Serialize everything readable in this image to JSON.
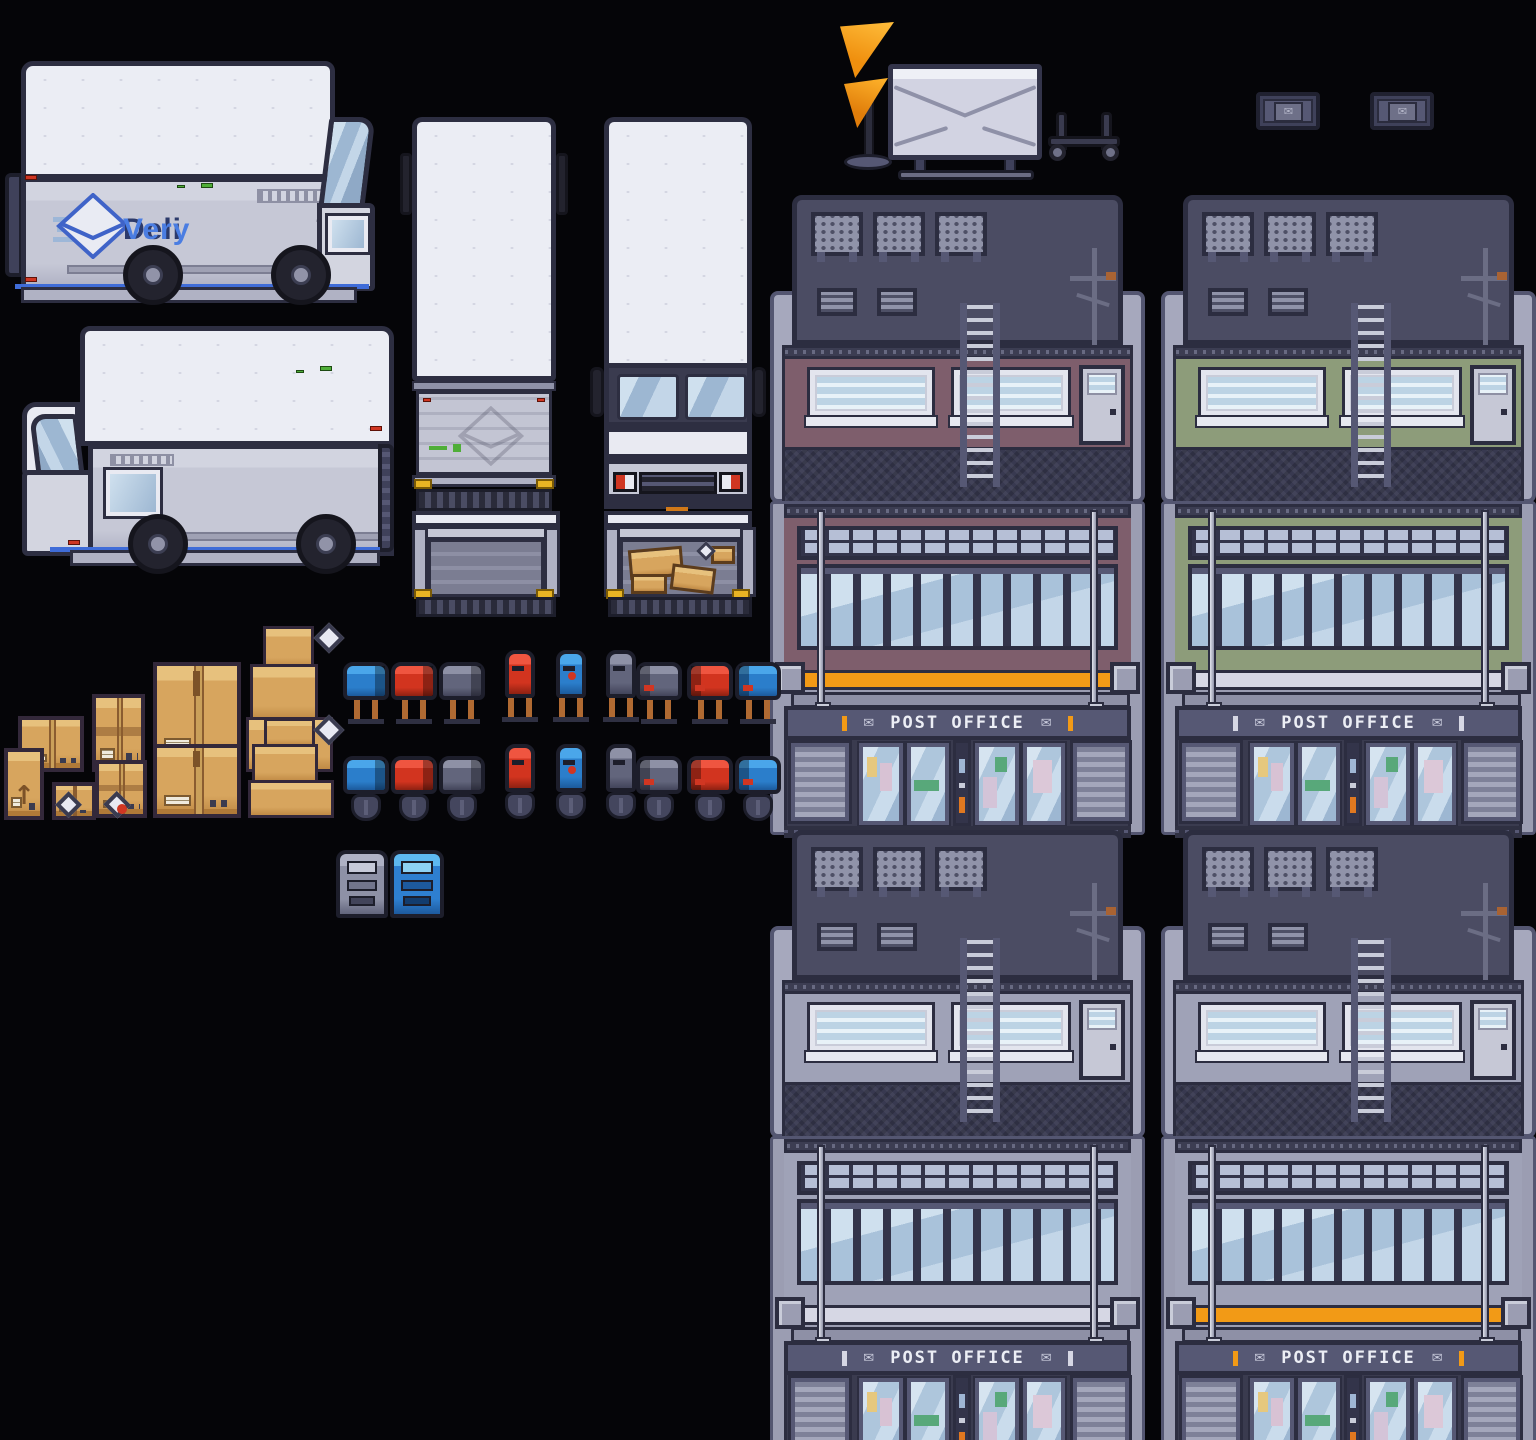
{
  "canvas": {
    "width": 1536,
    "height": 1440,
    "background": "#050508"
  },
  "truck_branding": {
    "logo_prefix": "Deli",
    "logo_suffix": "Very",
    "logo_prefix_color": "#2c3a6b",
    "logo_suffix_color": "#4a7de2"
  },
  "post_office_sign": {
    "label": "POST OFFICE",
    "text_color": "#eceef5"
  },
  "colors": {
    "outline": "#2d2e41",
    "truck_white": "#eceef5",
    "truck_silver": "#c6c8d6",
    "stripe_blue": "#3f6cd8",
    "accent_orange": "#f29a16",
    "stripe_lavender": "#d6d7e4",
    "wall_mauve": "#7e5e6c",
    "wall_green": "#8d9c7a",
    "wall_gray": "#9fa2b7",
    "mailbox_blue": "#2e7fd0",
    "mailbox_red": "#d03622",
    "mailbox_gray": "#62657c",
    "cardboard_tan": "#d7a55e",
    "rust": "#b06a32",
    "horn_orange": "#ef8f0e"
  },
  "trucks": [
    "delivery-box-truck-side-right",
    "delivery-van-side-left",
    "box-truck-top-down-rear",
    "box-truck-top-down-front",
    "box-truck-rear-open-empty",
    "box-truck-rear-open-loaded"
  ],
  "props": [
    "post-horn-sign",
    "envelope-sign",
    "hand-cart",
    "envelope-plaque",
    "envelope-plaque",
    "parcel-locker-gray",
    "parcel-locker-blue"
  ],
  "buildings": [
    {
      "id": "top-left",
      "wall": "#7e5e6c",
      "stripe": "#f29a16"
    },
    {
      "id": "top-right",
      "wall": "#8d9c7a",
      "stripe": "#d6d7e4"
    },
    {
      "id": "bottom-left",
      "wall": "#9fa2b7",
      "stripe": "#d6d7e4"
    },
    {
      "id": "bottom-right",
      "wall": "#9fa2b7",
      "stripe": "#f29a16"
    }
  ],
  "mailboxes": {
    "columns": [
      {
        "color": "blue",
        "view": "side-right"
      },
      {
        "color": "red",
        "view": "side-right"
      },
      {
        "color": "gray",
        "view": "side-right"
      },
      {
        "color": "red",
        "view": "front"
      },
      {
        "color": "blue",
        "view": "front"
      },
      {
        "color": "gray",
        "view": "front"
      },
      {
        "color": "gray",
        "view": "side-left"
      },
      {
        "color": "red",
        "view": "side-left"
      },
      {
        "color": "blue",
        "view": "side-left"
      }
    ],
    "rows": [
      {
        "base": "post-legs"
      },
      {
        "base": "pedestal"
      }
    ],
    "palette": {
      "blue": [
        "#4aa6ea",
        "#2b7ecb",
        "#1c5a9c"
      ],
      "red": [
        "#ef5540",
        "#d2341f",
        "#8e2112"
      ],
      "gray": [
        "#8e91a6",
        "#62657c",
        "#42445a"
      ]
    }
  },
  "packages": [
    "small-box",
    "medium-box",
    "large-box",
    "box-stack",
    "tall-box",
    "small-box",
    "medium-box",
    "large-box",
    "box-stack",
    "envelope",
    "envelope-stamped"
  ]
}
